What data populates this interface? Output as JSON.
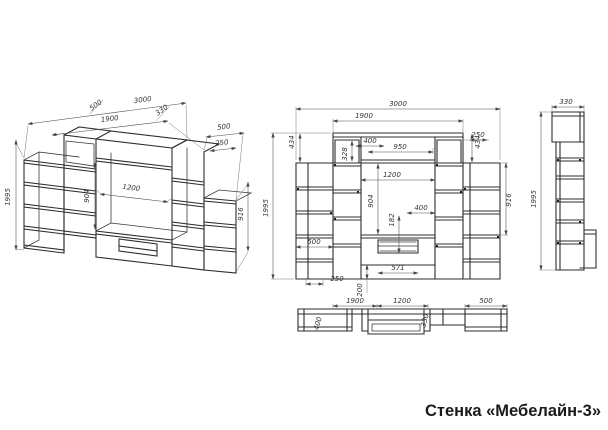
{
  "title": "Стенка «Мебелайн-3»",
  "colors": {
    "ink": "#2e2e2e",
    "background": "#ffffff"
  },
  "views": {
    "iso": {
      "overall_width": "3000",
      "center_width": "1900",
      "depth_left": "500",
      "depth_right": "330",
      "top_right_width": "500",
      "top_right_shelf": "250",
      "height": "1995",
      "niche_height": "904",
      "niche_width": "1200",
      "side_height": "916"
    },
    "front": {
      "overall_width": "3000",
      "center_width": "1900",
      "offset_left": "434",
      "offset_right": "434",
      "top_shelf": "400",
      "upper_niche": "950",
      "door_height": "328",
      "shelf_right": "250",
      "niche_width": "1200",
      "niche_height": "904",
      "drawer_height": "182",
      "lower_shelf": "400",
      "side_height": "916",
      "shelf_left": "500",
      "height": "1995",
      "base_shelf": "250",
      "base_height": "200",
      "drawer_width": "571"
    },
    "side": {
      "depth": "330",
      "height": "1995"
    },
    "plan": {
      "left_section": "1900",
      "center_section": "1200",
      "right_section": "500",
      "depth_left": "400",
      "depth_center": "330"
    }
  }
}
